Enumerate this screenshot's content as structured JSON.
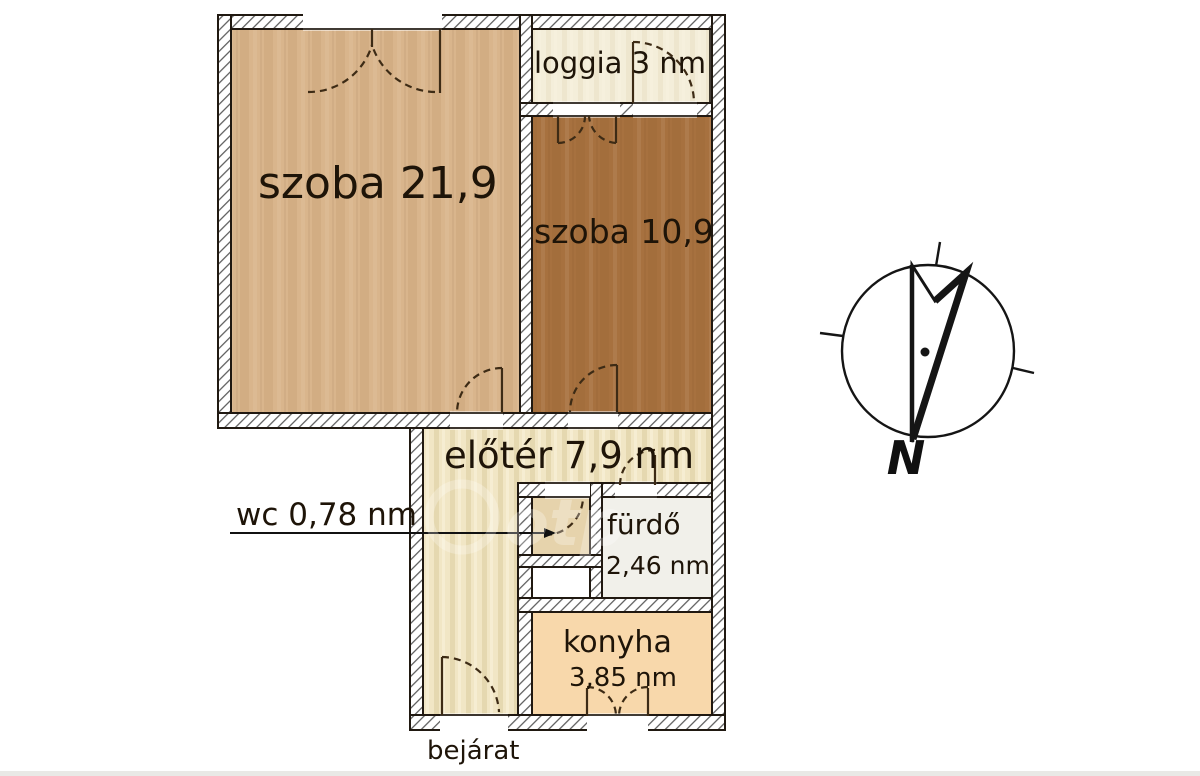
{
  "rooms": {
    "szoba_large": {
      "label": "szoba 21,9",
      "color": "#d9b58c"
    },
    "szoba_small": {
      "label": "szoba 10,9",
      "color": "#a7713f"
    },
    "loggia": {
      "label": "loggia 3 nm",
      "color": "#f4eeda"
    },
    "eloter": {
      "label": "előtér 7,9 nm",
      "color": "#f1e6c5"
    },
    "wc": {
      "label": "wc 0,78 nm",
      "color": "#e6d3ac"
    },
    "furdo": {
      "label": "fürdő",
      "area": "2,46 nm",
      "color": "#f1f0ea"
    },
    "konyha": {
      "label": "konyha",
      "area": "3,85 nm",
      "color": "#f8d8ab"
    }
  },
  "entrance": {
    "label": "bejárat"
  },
  "compass": {
    "north_label": "N"
  },
  "watermark": {
    "text": "otp"
  },
  "palette": {
    "wall_hatch": "#4d4d4d",
    "outline": "#201911",
    "door_line": "#3d2b15",
    "text": "#1e1408",
    "leader_line": "#111111"
  }
}
